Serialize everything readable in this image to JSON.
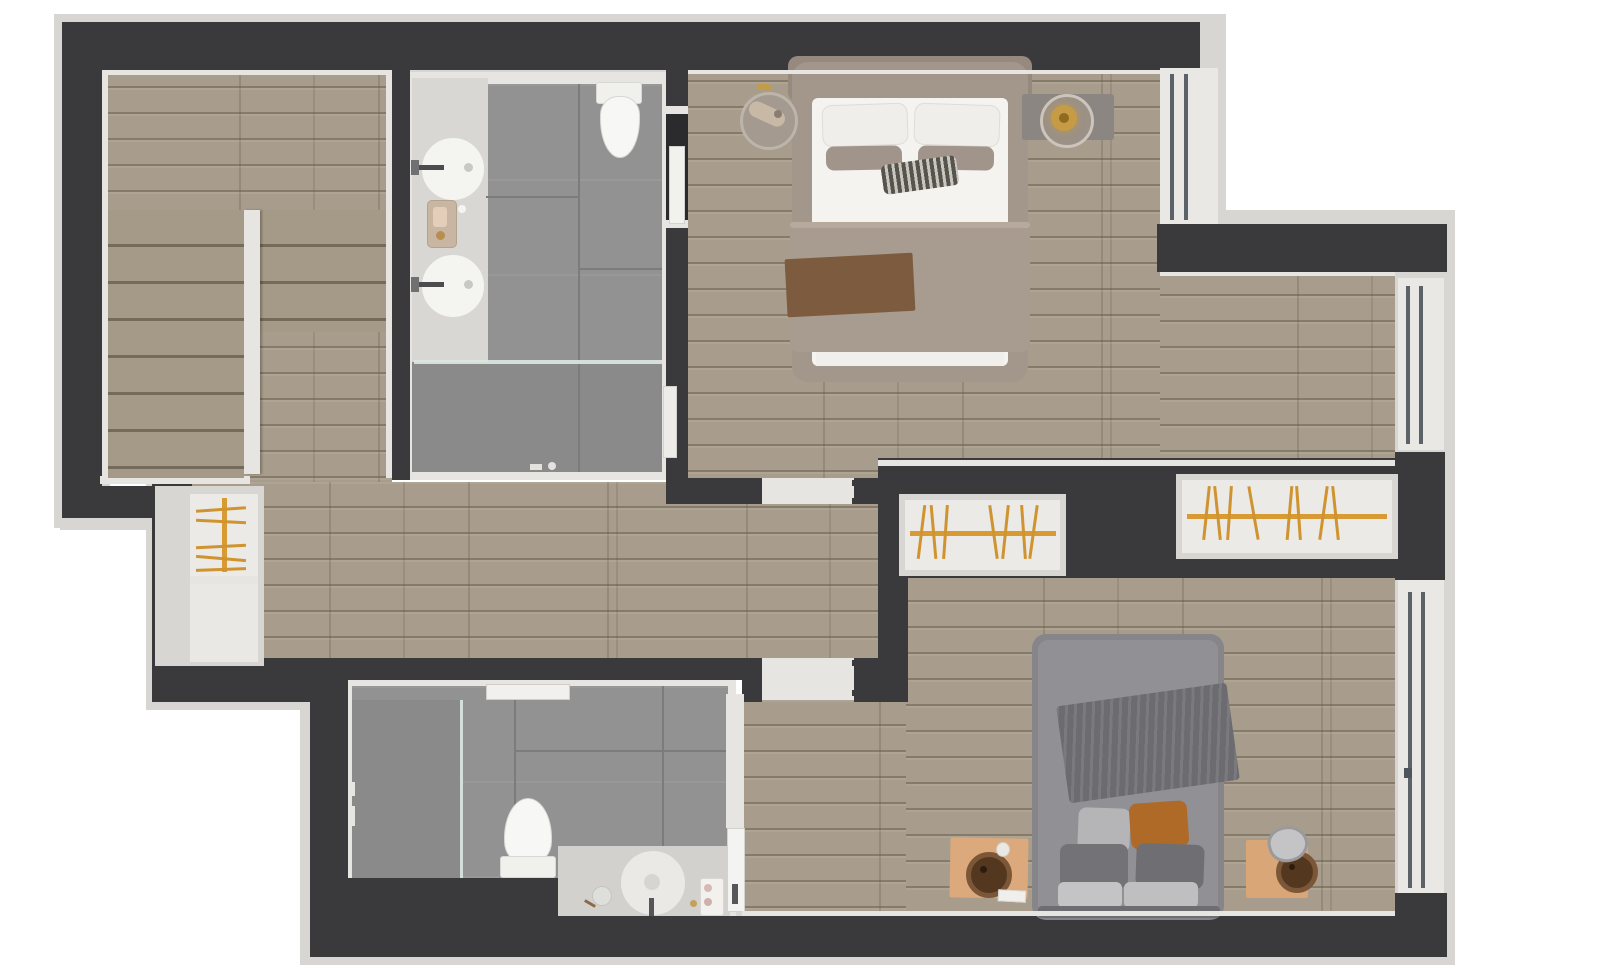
{
  "page": {
    "title": "3D floor plan — upper floor, top-down render",
    "background_color": "#ffffff",
    "visible_text": []
  },
  "plan": {
    "type": "3d-floor-plan-top-view",
    "rooms": [
      {
        "name": "staircase",
        "floor": "wood",
        "features": [
          "upper-landing",
          "double-flight-stairs",
          "center-divider-wall"
        ]
      },
      {
        "name": "ensuite-bathroom",
        "floor": "gray-tile",
        "features": [
          "vanity-counter",
          "two-round-vessel-sinks",
          "wall-faucets",
          "cosmetics-tray",
          "toilet",
          "walk-in-shower",
          "glass-partition",
          "door-to-master-bedroom"
        ]
      },
      {
        "name": "master-bedroom",
        "floor": "wood",
        "features": [
          "double-bed",
          "upholstered-headboard",
          "white-pillows",
          "taupe-accent-pillows",
          "striped-pillow",
          "taupe-duvet",
          "brown-throw-runner",
          "round-side-table-left",
          "round-side-table-right-with-lamp",
          "gray-rug",
          "window-top-right"
        ]
      },
      {
        "name": "dressing-area",
        "floor": "wood",
        "features": [
          "window-right"
        ]
      },
      {
        "name": "hallway",
        "floor": "wood",
        "features": [
          "door-to-master-bedroom",
          "door-to-bedroom-2",
          "small-built-in-closet",
          "storage-compartment"
        ]
      },
      {
        "name": "built-in-closet-left",
        "features": [
          "orange-clothes-rail",
          "wooden-hangers"
        ]
      },
      {
        "name": "built-in-closet-right",
        "features": [
          "orange-clothes-rail",
          "wooden-hangers"
        ]
      },
      {
        "name": "second-bathroom",
        "floor": "gray-tile",
        "features": [
          "walk-in-shower",
          "glass-partition",
          "wall-shelf",
          "toilet",
          "round-basin-vanity",
          "vanity-accessories",
          "pocket-door"
        ]
      },
      {
        "name": "bedroom-2",
        "floor": "wood",
        "features": [
          "double-bed-gray",
          "knit-throw-blanket",
          "gray-pillows",
          "cognac-leather-pillow",
          "square-wood-nightstand-left",
          "square-wood-nightstand-right",
          "round-wicker-baskets",
          "decor-items",
          "window-right"
        ]
      }
    ],
    "window_count": 3,
    "door_thresholds": 2,
    "palette": {
      "outer_wall": "#3a3a3c",
      "wall_trim": "#d7d6d2",
      "inner_trim": "#e6e5e1",
      "wood_floor": "#a89d8c",
      "wood_plank_line": "#5d503e",
      "tile_floor": "#929292",
      "tile_shower": "#8a8a8a",
      "closet_interior": "#ebeae7",
      "clothes_rail_orange": "#d89a33",
      "hanger_orange": "#cf9430",
      "master_bed_taupe": "#a3968a",
      "mattress_white": "#f4f3f0",
      "duvet_taupe": "#a89b8f",
      "throw_brown": "#7c5b3e",
      "striped_pillow_dark": "#57534d",
      "bed2_gray": "#909095",
      "blanket_gray": "#6b6b70",
      "cognac_pillow": "#b06a28",
      "nightstand_wood": "#dba97b",
      "basket_brown": "#53381f",
      "lamp_amber": "#c79b45",
      "window_glazing": "#5b6268",
      "glass_partition": "#dbe8e2"
    }
  }
}
